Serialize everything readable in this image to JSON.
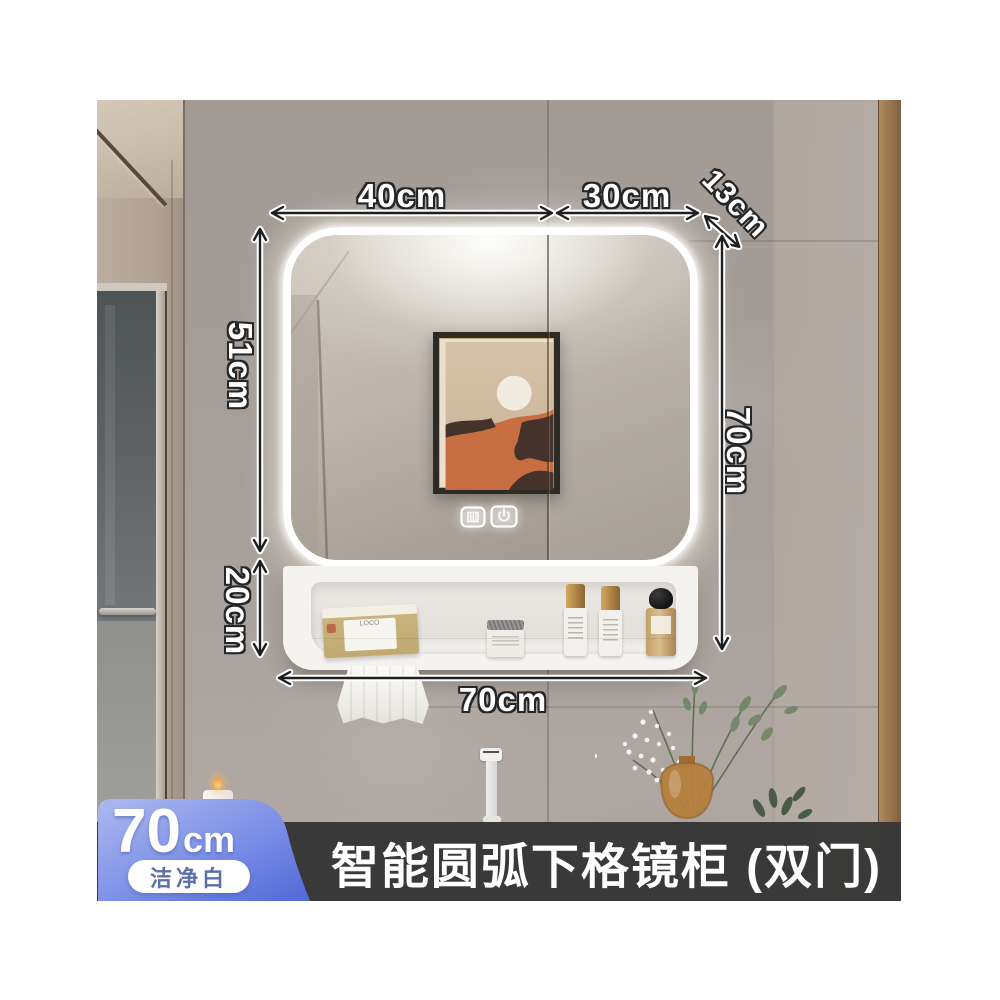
{
  "banner": {
    "title": "智能圆弧下格镜柜 (双门)"
  },
  "badge": {
    "value": "70",
    "unit": "cm",
    "finish": "洁净白"
  },
  "dims": {
    "top_width_left": "40cm",
    "top_width_right": "30cm",
    "depth": "13cm",
    "mirror_height": "51cm",
    "shelf_height": "20cm",
    "total_height": "70cm",
    "total_width": "70cm"
  },
  "shelf": {
    "tissue_label": "LOCO"
  },
  "icons": {
    "mirror_touch": [
      "defog-icon",
      "power-icon"
    ]
  },
  "colors": {
    "badge_gradient_top": "#aeb9f0",
    "badge_gradient_bottom": "#5068d6",
    "banner_bg": "#363636",
    "led_glow": "#ffffff",
    "wall": "#a79f99",
    "wood_trim": "#96734e"
  }
}
